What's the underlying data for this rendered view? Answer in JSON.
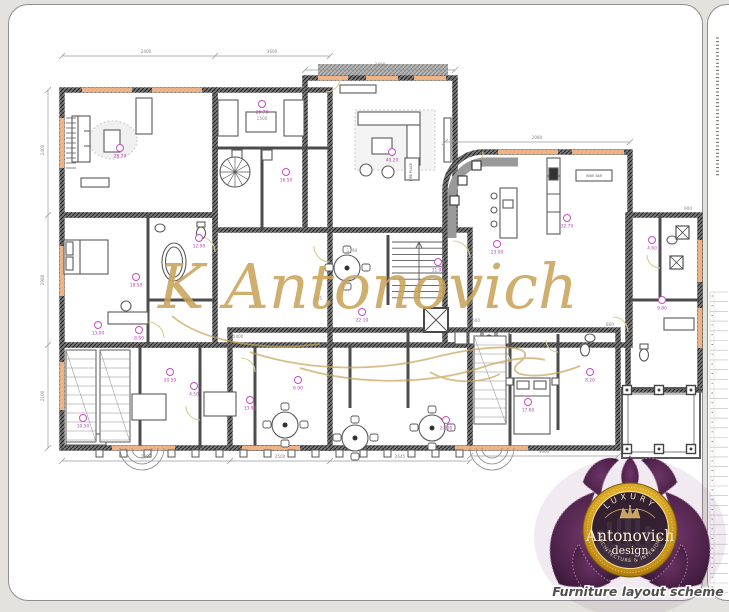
{
  "page": {
    "background_color": "#e3e2de",
    "sheet_border_color": "#8f8f8f"
  },
  "watermark": {
    "text": "K Antonovich",
    "color": "#c9a35b"
  },
  "caption": {
    "text": "Furniture layout scheme",
    "color": "#4e4e4e"
  },
  "logo": {
    "luxury": "LUXURY",
    "name": "Antonovich",
    "design": "· design ·",
    "tagline": "ARCHITECTURE & INTERIORS",
    "gold_color": "#d4a017",
    "purple_color": "#5a2a54"
  },
  "plan": {
    "wall_color": "#6f6f6f",
    "line_color": "#4c4c4c",
    "window_color": "#eeb287",
    "door_arc_color": "#d8cd92",
    "area_label_color": "#b644b6",
    "dim_label_color": "#8a8a8a",
    "area_labels": [
      {
        "x": 120,
        "y": 148,
        "v": "28.70"
      },
      {
        "x": 262,
        "y": 104,
        "v": "26.70"
      },
      {
        "x": 286,
        "y": 172,
        "v": "16.50"
      },
      {
        "x": 392,
        "y": 152,
        "v": "40.20"
      },
      {
        "x": 567,
        "y": 218,
        "v": "32.70"
      },
      {
        "x": 497,
        "y": 244,
        "v": "23.00"
      },
      {
        "x": 136,
        "y": 277,
        "v": "18.50"
      },
      {
        "x": 199,
        "y": 238,
        "v": "12.90"
      },
      {
        "x": 98,
        "y": 325,
        "v": "13.00"
      },
      {
        "x": 139,
        "y": 330,
        "v": "8.80"
      },
      {
        "x": 170,
        "y": 372,
        "v": "20.50"
      },
      {
        "x": 83,
        "y": 418,
        "v": "10.50"
      },
      {
        "x": 194,
        "y": 386,
        "v": "4.50"
      },
      {
        "x": 250,
        "y": 400,
        "v": "13.90"
      },
      {
        "x": 298,
        "y": 380,
        "v": "6.90"
      },
      {
        "x": 362,
        "y": 312,
        "v": "22.10"
      },
      {
        "x": 438,
        "y": 262,
        "v": "11.90"
      },
      {
        "x": 528,
        "y": 402,
        "v": "17.60"
      },
      {
        "x": 590,
        "y": 372,
        "v": "8.20"
      },
      {
        "x": 662,
        "y": 300,
        "v": "9.80"
      },
      {
        "x": 652,
        "y": 240,
        "v": "4.60"
      },
      {
        "x": 446,
        "y": 420,
        "v": "27.00"
      }
    ],
    "dim_labels": [
      {
        "x": 146,
        "y": 53,
        "v": "2400",
        "r": 0
      },
      {
        "x": 272,
        "y": 53,
        "v": "3600",
        "r": 0
      },
      {
        "x": 380,
        "y": 66,
        "v": "2400",
        "r": 0
      },
      {
        "x": 537,
        "y": 139,
        "v": "2080",
        "r": 0
      },
      {
        "x": 44,
        "y": 150,
        "v": "2400",
        "r": -90
      },
      {
        "x": 44,
        "y": 280,
        "v": "2980",
        "r": -90
      },
      {
        "x": 44,
        "y": 396,
        "v": "2100",
        "r": -90
      },
      {
        "x": 146,
        "y": 458,
        "v": "2400",
        "r": 0
      },
      {
        "x": 280,
        "y": 458,
        "v": "2500",
        "r": 0
      },
      {
        "x": 400,
        "y": 458,
        "v": "2645",
        "r": 0
      },
      {
        "x": 544,
        "y": 453,
        "v": "4600",
        "r": 0
      },
      {
        "x": 352,
        "y": 252,
        "v": "1190",
        "r": 0
      },
      {
        "x": 262,
        "y": 120,
        "v": "1500",
        "r": 0
      },
      {
        "x": 476,
        "y": 322,
        "v": "600",
        "r": 0
      },
      {
        "x": 610,
        "y": 326,
        "v": "800",
        "r": 0
      },
      {
        "x": 688,
        "y": 210,
        "v": "900",
        "r": 0
      },
      {
        "x": 238,
        "y": 338,
        "v": "5400",
        "r": 0
      },
      {
        "x": 318,
        "y": 300,
        "v": "695",
        "r": 0
      }
    ],
    "annotations": [
      {
        "x": 594,
        "y": 177,
        "v": "WINE BAR",
        "r": 0
      },
      {
        "x": 412,
        "y": 172,
        "v": "FIRE PLACE",
        "r": -90
      }
    ]
  }
}
